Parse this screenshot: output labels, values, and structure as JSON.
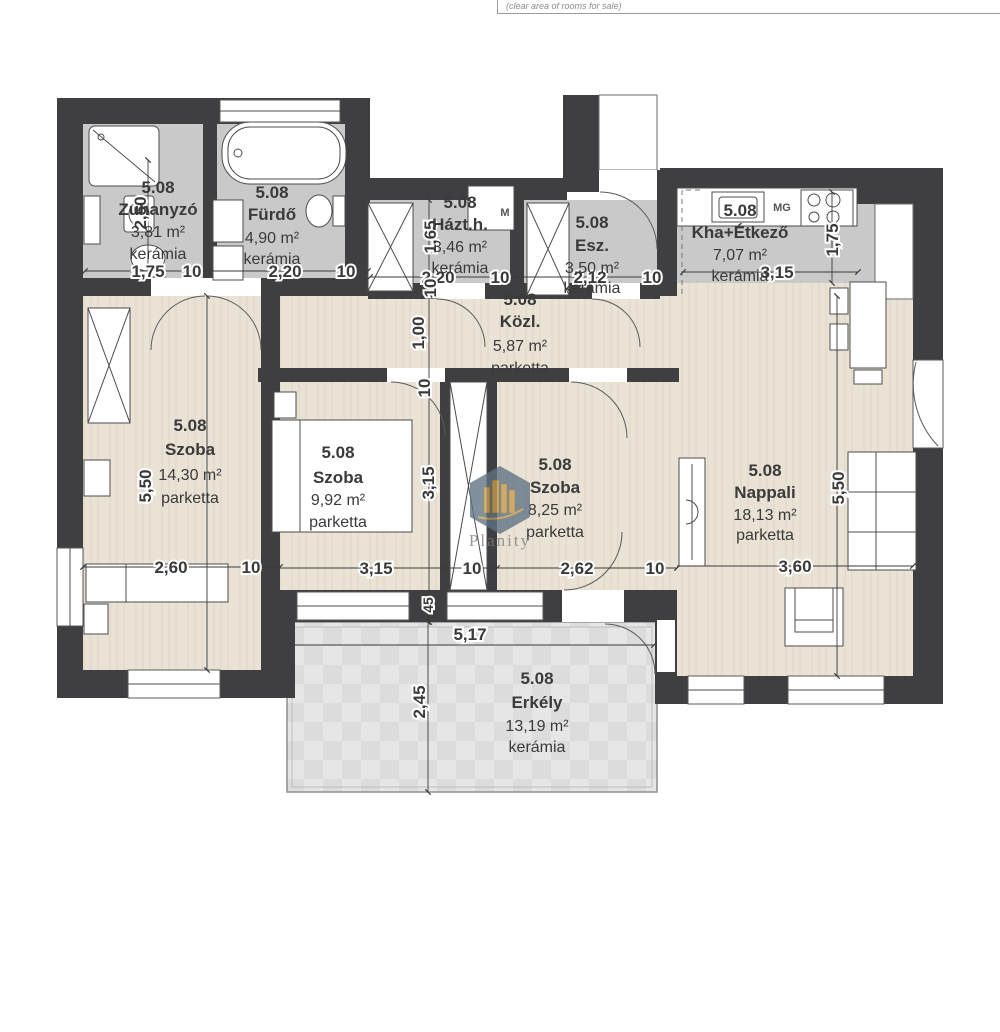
{
  "header": {
    "note": "(clear area of rooms for sale)"
  },
  "watermark": {
    "text": "Planity"
  },
  "rooms": {
    "zuhanyzo": {
      "unit": "5.08",
      "name": "Zuhanyzó",
      "area": "3,81 m²",
      "floor": "kerámia"
    },
    "furdo": {
      "unit": "5.08",
      "name": "Fürdő",
      "area": "4,90 m²",
      "floor": "kerámia"
    },
    "hazth": {
      "unit": "5.08",
      "name": "Házt.h.",
      "area": "3,46 m²",
      "floor": "kerámia"
    },
    "esz": {
      "unit": "5.08",
      "name": "Esz.",
      "area": "3,50 m²",
      "floor": "kerámia"
    },
    "konyha": {
      "unit": "5.08",
      "name": "Kha+Étkező",
      "area": "7,07 m²",
      "floor": "kerámia"
    },
    "kozl": {
      "unit": "5.08",
      "name": "Közl.",
      "area": "5,87 m²",
      "floor": "parketta"
    },
    "szoba1": {
      "unit": "5.08",
      "name": "Szoba",
      "area": "14,30 m²",
      "floor": "parketta"
    },
    "szoba2": {
      "unit": "5.08",
      "name": "Szoba",
      "area": "9,92 m²",
      "floor": "parketta"
    },
    "szoba3": {
      "unit": "5.08",
      "name": "Szoba",
      "area": "8,25 m²",
      "floor": "parketta"
    },
    "nappali": {
      "unit": "5.08",
      "name": "Nappali",
      "area": "18,13 m²",
      "floor": "parketta"
    },
    "erkely": {
      "unit": "5.08",
      "name": "Erkély",
      "area": "13,19 m²",
      "floor": "kerámia"
    }
  },
  "fixtures": {
    "washer": "M",
    "dishwasher": "MG"
  },
  "dims": {
    "w10": "10",
    "w45": "45",
    "d100": "1,00",
    "d165": "1,65",
    "d175": "1,75",
    "d212": "2,12",
    "d220": "2,20",
    "d245": "2,45",
    "d250": "2,50",
    "d260": "2,60",
    "d262": "2,62",
    "d315": "3,15",
    "d360": "3,60",
    "d517": "5,17",
    "d550": "5,50"
  },
  "colors": {
    "wall": "#3f3f41",
    "ceramic": "#c9c9c9",
    "parquet": "#e9e2d5",
    "balcony": "#e4e4e4",
    "text": "#3a3a3a",
    "watermark_badge": "#5d7282",
    "watermark_gold": "#c89c4e"
  }
}
